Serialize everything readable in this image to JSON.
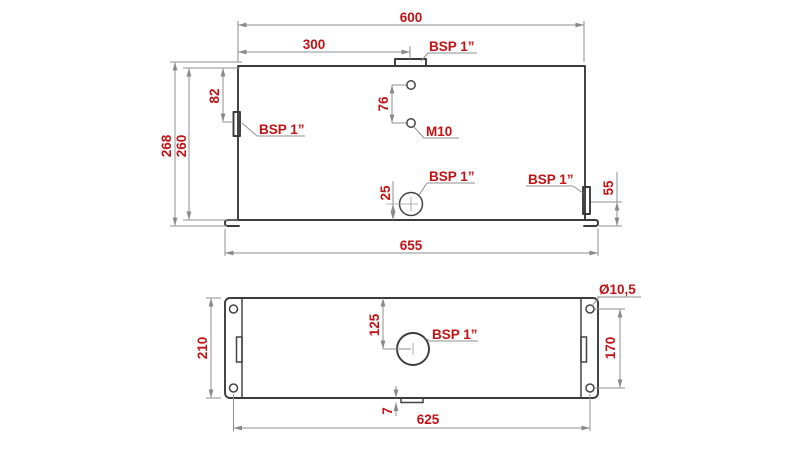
{
  "colors": {
    "dimension_text": "#c41114",
    "object_line": "#3b3b3b",
    "dimension_line": "#8f8f8f",
    "background": "#ffffff"
  },
  "front_view": {
    "dim_top_width": "600",
    "dim_half_width": "300",
    "port_top_label": "BSP 1”",
    "dim_left_port_offset": "82",
    "port_left_label": "BSP 1”",
    "dim_overall_height": "268",
    "dim_body_height": "260",
    "dim_hole_spacing": "76",
    "hole_thread_label": "M10",
    "dim_drain_offset": "25",
    "port_drain_label": "BSP 1”",
    "port_right_label": "BSP 1”",
    "dim_right_port_offset": "55",
    "dim_base_width": "655"
  },
  "plan_view": {
    "dim_depth": "210",
    "dim_port_offset": "125",
    "port_center_label": "BSP 1”",
    "hole_diameter_label": "Ø10,5",
    "dim_hole_spacing_vertical": "170",
    "dim_tab_offset": "7",
    "dim_hole_spacing_horizontal": "625"
  }
}
